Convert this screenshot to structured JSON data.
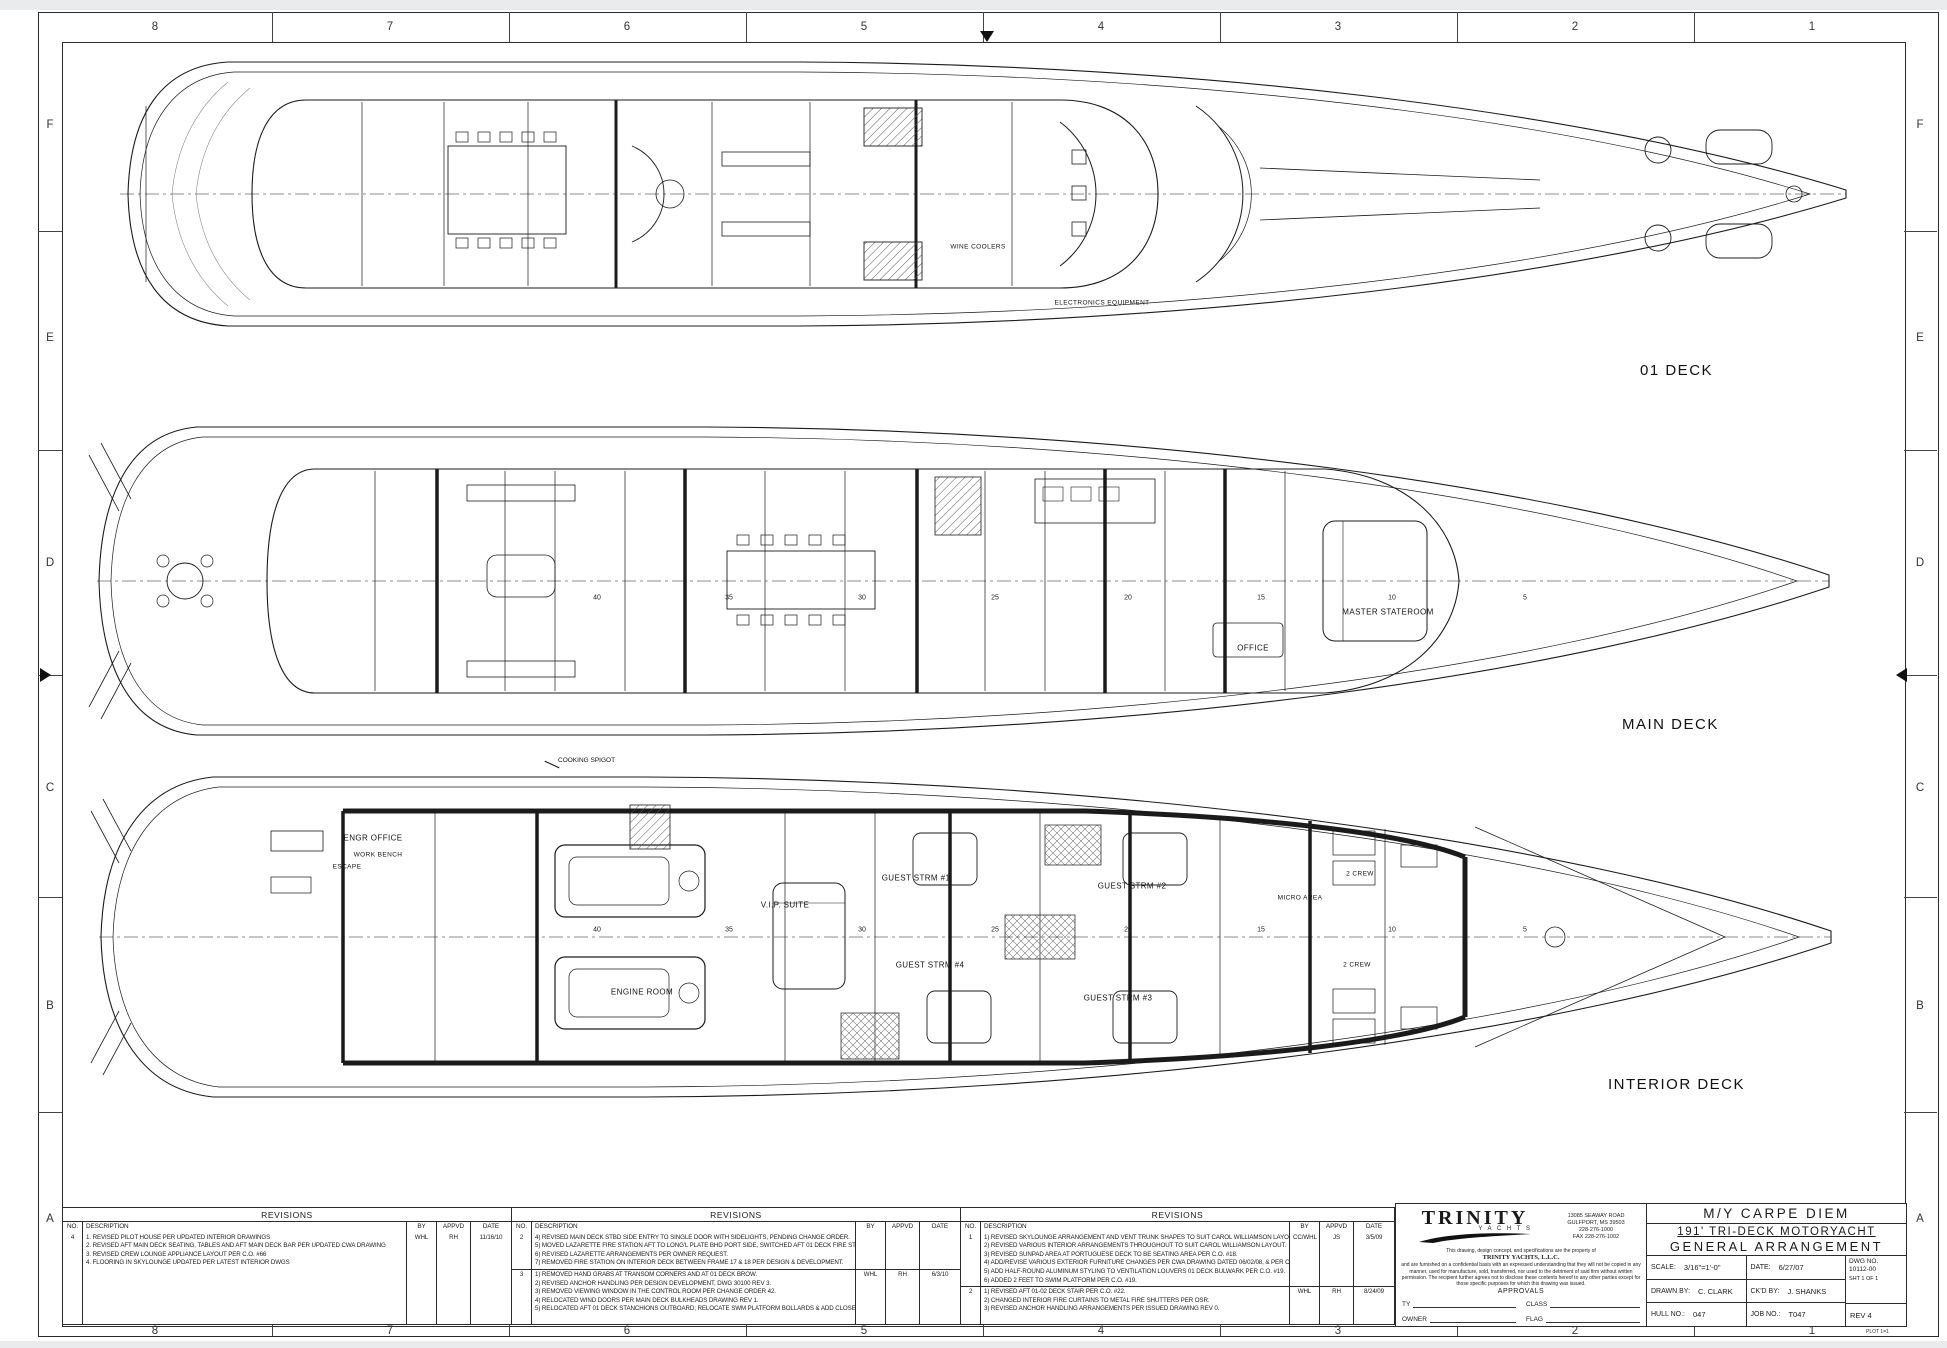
{
  "sheet": {
    "zones_top": [
      "8",
      "7",
      "6",
      "5",
      "4",
      "3",
      "2",
      "1"
    ],
    "zones_bottom": [
      "8",
      "7",
      "6",
      "5",
      "4",
      "3",
      "2",
      "1"
    ],
    "zones_left": [
      "F",
      "E",
      "D",
      "C",
      "B",
      "A"
    ],
    "zones_right": [
      "F",
      "E",
      "D",
      "C",
      "B",
      "A"
    ],
    "line_color": "#1b1b1b",
    "background": "#ffffff",
    "margin_color": "#e9ebec"
  },
  "plans": {
    "deck01": {
      "label": "01 DECK",
      "labels": [
        "WINE COOLERS",
        "ELECTRONICS EQUIPMENT"
      ]
    },
    "main": {
      "label": "MAIN DECK",
      "labels": [
        "OFFICE",
        "MASTER STATEROOM"
      ],
      "frames": [
        "40",
        "35",
        "30",
        "25",
        "20",
        "15",
        "10",
        "5"
      ]
    },
    "interior": {
      "label": "INTERIOR DECK",
      "callout": "COOKING SPIGOT",
      "labels": [
        "ENGR OFFICE",
        "ENGINE ROOM",
        "V.I.P. SUITE",
        "GUEST STRM #1",
        "GUEST STRM #2",
        "GUEST STRM #3",
        "GUEST STRM #4",
        "2 CREW",
        "2 CREW",
        "MICRO AREA",
        "ESCAPE",
        "WORK BENCH"
      ],
      "frames": [
        "40",
        "35",
        "30",
        "25",
        "20",
        "15",
        "10",
        "5"
      ]
    }
  },
  "revisions": [
    {
      "title": "REVISIONS",
      "headers": {
        "no": "NO.",
        "desc": "DESCRIPTION",
        "by": "BY",
        "appvd": "APPVD",
        "date": "DATE"
      },
      "rows": [
        {
          "no": "4",
          "by": "WHL",
          "appvd": "RH",
          "date": "11/16/10",
          "lines": [
            "1.  REVISED PILOT HOUSE PER UPDATED INTERIOR DRAWINGS",
            "2.  REVISED AFT MAIN DECK SEATING, TABLES AND AFT MAIN DECK BAR PER UPDATED CWA DRAWING",
            "3.  REVISED CREW LOUNGE APPLIANCE LAYOUT PER C.O. #66",
            "4.  FLOORING IN SKYLOUNGE UPDATED PER LATEST INTERIOR DWGS"
          ]
        }
      ]
    },
    {
      "title": "REVISIONS",
      "headers": {
        "no": "NO.",
        "desc": "DESCRIPTION",
        "by": "BY",
        "appvd": "APPVD",
        "date": "DATE"
      },
      "rows": [
        {
          "no": "2",
          "by": "",
          "appvd": "",
          "date": "",
          "lines": [
            "4)  REVISED MAIN DECK STBD SIDE ENTRY TO SINGLE DOOR WITH SIDELIGHTS, PENDING CHANGE ORDER.",
            "5)  MOVED LAZARETTE FIRE STATION AFT TO LONG'L PLATE BHD PORT SIDE, SWITCHED AFT 01 DECK FIRE STATION PORT TO STBD.",
            "6)  REVISED LAZARETTE ARRANGEMENTS PER OWNER REQUEST.",
            "7)  REMOVED FIRE STATION ON INTERIOR DECK BETWEEN FRAME 17 & 18 PER DESIGN & DEVELOPMENT."
          ]
        },
        {
          "no": "3",
          "by": "WHL",
          "appvd": "RH",
          "date": "6/3/10",
          "lines": [
            "1)  REMOVED HAND GRABS AT TRANSOM CORNERS AND AT 01 DECK BROW.",
            "2)  REVISED ANCHOR HANDLING PER DESIGN DEVELOPMENT, DWG 30100 REV 3.",
            "3)  REMOVED VIEWING WINDOW IN THE CONTROL ROOM PER CHANGE ORDER 42.",
            "4)  RELOCATED WIND DOORS PER MAIN DECK BULKHEADS DRAWING REV 1.",
            "5)  RELOCATED AFT 01 DECK STANCHIONS OUTBOARD; RELOCATE SWM PLATFORM BOLLARDS & ADD CLOSED CHOCKS PER C.O. 056."
          ]
        }
      ]
    },
    {
      "title": "REVISIONS",
      "headers": {
        "no": "NO.",
        "desc": "DESCRIPTION",
        "by": "BY",
        "appvd": "APPVD",
        "date": "DATE"
      },
      "rows": [
        {
          "no": "1",
          "by": "CC/WHL",
          "appvd": "JS",
          "date": "3/5/09",
          "lines": [
            "1)  REVISED SKYLOUNGE ARRANGEMENT AND VENT TRUNK SHAPES TO SUIT CAROL WILLIAMSON LAYOUT.",
            "2)  REVISED VARIOUS INTERIOR ARRANGEMENTS THROUGHOUT TO SUIT CAROL WILLIAMSON LAYOUT.",
            "3)  REVISED SUNPAD AREA AT PORTUGUESE DECK TO BE SEATING AREA PER C.O. #18.",
            "4)  ADD/REVISE VARIOUS EXTERIOR FURNITURE CHANGES PER CWA DRAWING DATED 06/02/08, & PER C.O. #19.",
            "5)  ADD HALF-ROUND ALUMINUM STYLING TO VENTILATION LOUVERS 01 DECK BULWARK PER C.O. #19.",
            "6)  ADDED 2 FEET TO SWIM PLATFORM PER C.O. #19."
          ]
        },
        {
          "no": "2",
          "by": "WHL",
          "appvd": "RH",
          "date": "8/24/09",
          "lines": [
            "1)  REVISED AFT 01-02 DECK STAIR PER C.O. #22.",
            "2)  CHANGED INTERIOR FIRE CURTAINS TO METAL FIRE SHUTTERS PER OSR.",
            "3)  REVISED ANCHOR HANDLING ARRANGEMENTS PER ISSUED DRAWING REV 0."
          ]
        }
      ]
    }
  ],
  "title_block": {
    "company": {
      "logo_name": "TRINITY",
      "logo_sub": "Y A C H T S",
      "address": [
        "13085 SEAWAY ROAD",
        "GULFPORT, MS 39503",
        "228-276-1000",
        "FAX 228-276-1002"
      ],
      "legal_intro": "This drawing, design concept, and specifications are the property of",
      "legal_company": "TRINITY YACHTS, L.L.C.",
      "legal_body": "and are furnished on a confidential basis with an expressed understanding that they will not be copied in any manner, used for manufacture, sold, transferred, nor used to the detriment of said firm without written permission. The recipient further agrees not to disclose these contents hereof to any other parties except for those specific purposes for which this drawing was issued.",
      "approvals_title": "APPROVALS",
      "approvals": [
        "TY",
        "OWNER",
        "CLASS",
        "FLAG"
      ]
    },
    "titles": {
      "line1": "M/Y CARPE DIEM",
      "line2": "191' TRI-DECK MOTORYACHT",
      "line3": "GENERAL ARRANGEMENT"
    },
    "fields": {
      "scale_label": "SCALE:",
      "scale": "3/16\"=1'-0\"",
      "date_label": "DATE:",
      "date": "6/27/07",
      "dwg_label": "DWG NO.",
      "dwg_no": "10112-00",
      "sheet": "SHT 1 OF 1",
      "drawn_label": "DRAWN BY:",
      "drawn": "C. CLARK",
      "ckd_label": "CK'D BY:",
      "ckd": "J. SHANKS",
      "hull_label": "HULL NO.:",
      "hull": "047",
      "job_label": "JOB NO.:",
      "job": "T047",
      "rev": "REV 4",
      "plot_note": "PLOT 1=1"
    }
  }
}
